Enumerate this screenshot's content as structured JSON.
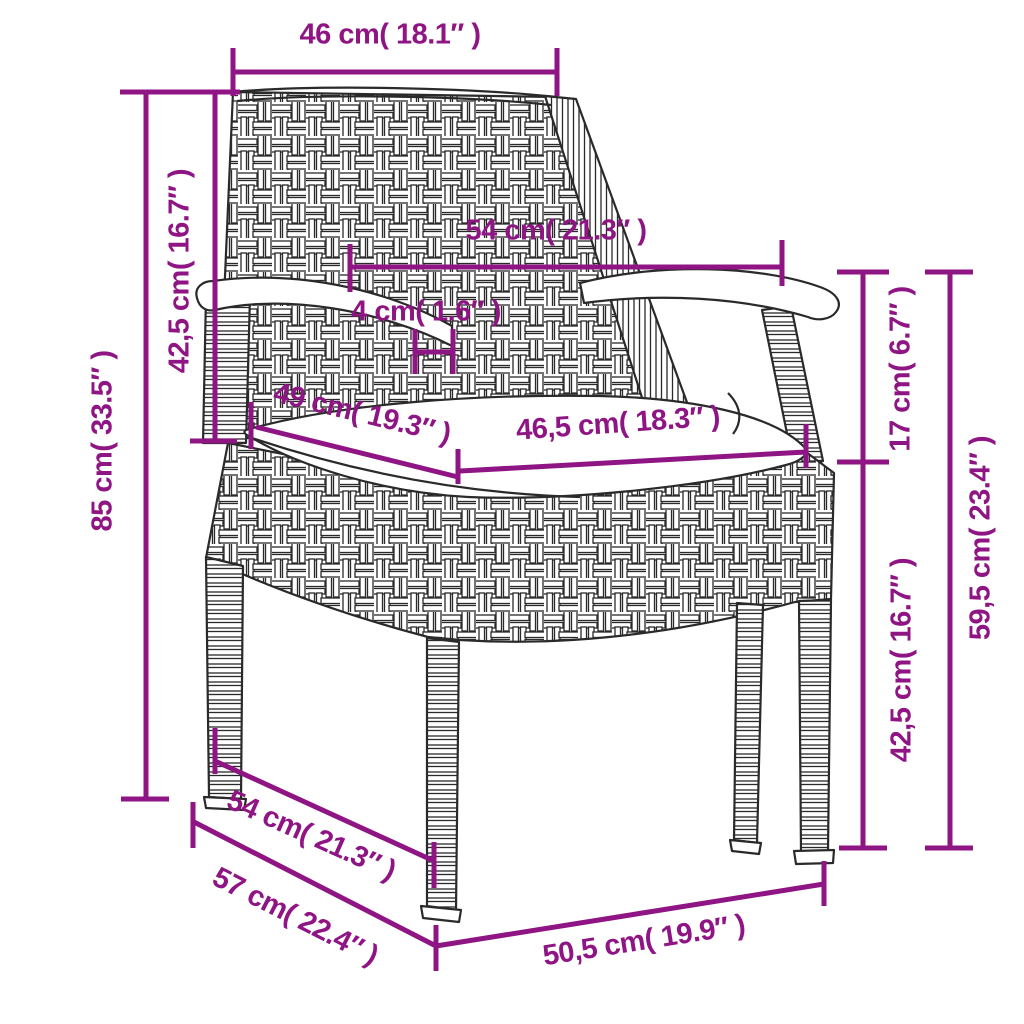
{
  "diagram": {
    "subject": "rattan garden chair with seat cushion, dimension drawing",
    "background_color": "#ffffff",
    "accent_color": "#8E1583",
    "line_art_color": "#2a2a2a",
    "dimensions": [
      {
        "id": "back-width",
        "label": "46 cm( 18.1″ )"
      },
      {
        "id": "backrest-height",
        "label": "42,5 cm( 16.7″ )"
      },
      {
        "id": "total-height",
        "label": "85 cm( 33.5″ )"
      },
      {
        "id": "armrest-span",
        "label": "54 cm( 21.3″ )"
      },
      {
        "id": "armrest-thickness",
        "label": "4 cm( 1.6″ )"
      },
      {
        "id": "seat-depth",
        "label": "49 cm( 19.3″ )"
      },
      {
        "id": "seat-width",
        "label": "46,5 cm( 18.3″ )"
      },
      {
        "id": "armrest-to-seat",
        "label": "17 cm( 6.7″ )"
      },
      {
        "id": "seat-height",
        "label": "42,5 cm( 16.7″ )"
      },
      {
        "id": "armrest-height",
        "label": "59,5 cm( 23.4″ )"
      },
      {
        "id": "base-depth",
        "label": "54 cm( 21.3″ )"
      },
      {
        "id": "floor-depth",
        "label": "57 cm( 22.4″ )"
      },
      {
        "id": "base-width",
        "label": "50,5 cm( 19.9″ )"
      }
    ]
  }
}
